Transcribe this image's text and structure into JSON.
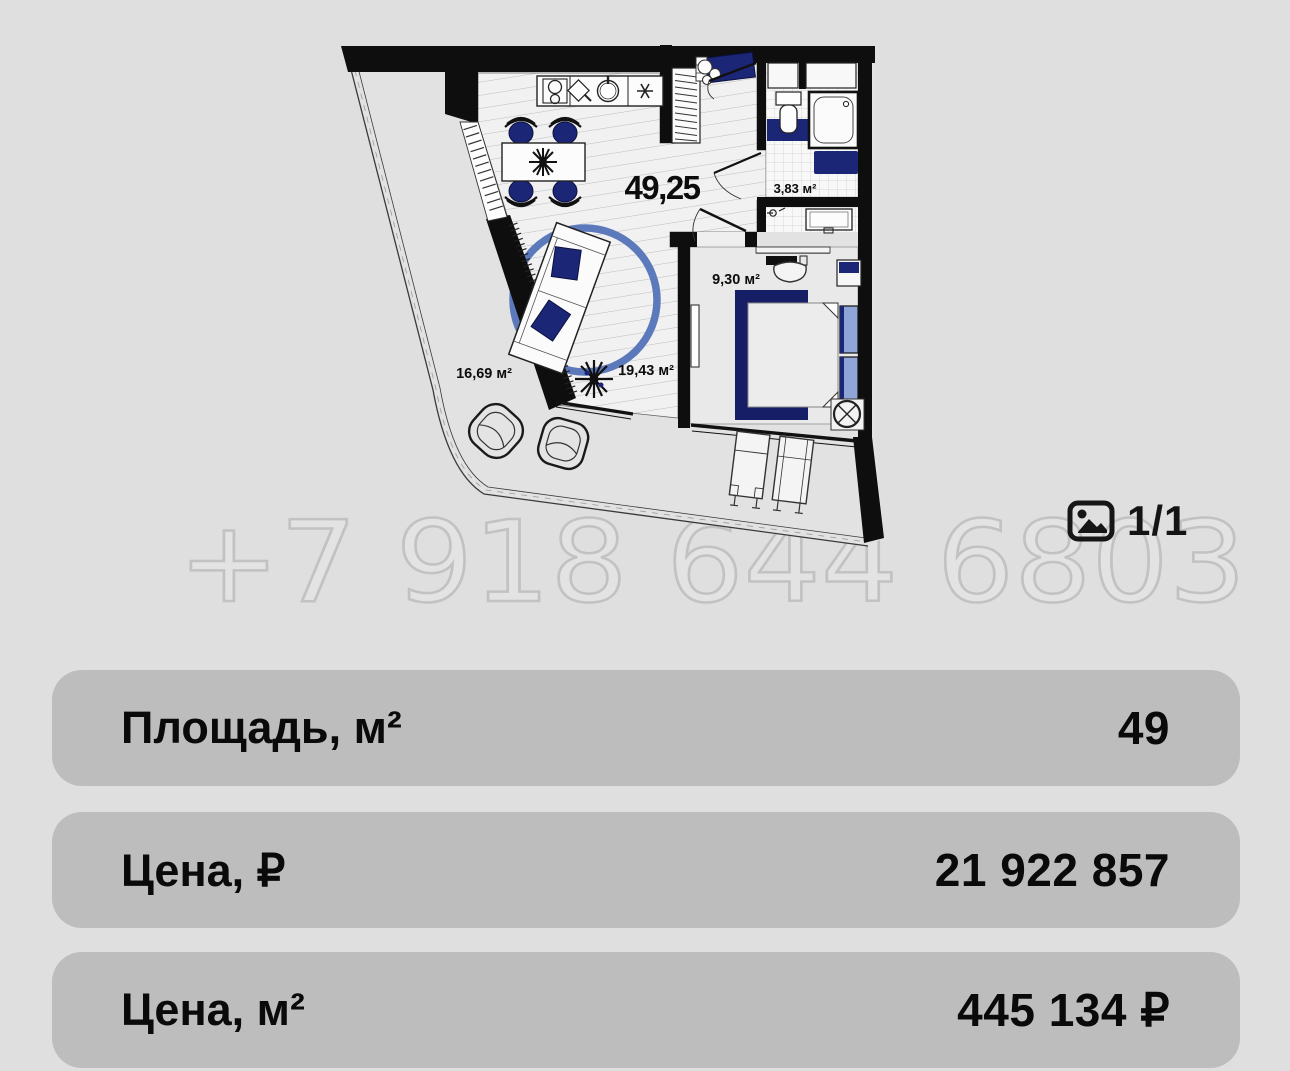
{
  "watermark": {
    "text": "+7 918 644 6803"
  },
  "gallery": {
    "counter": "1/1",
    "icon": "photo-icon"
  },
  "plan": {
    "total_area": "49,25",
    "rooms": [
      {
        "name": "bathroom",
        "area_label": "3,83 м²"
      },
      {
        "name": "bedroom",
        "area_label": "9,30 м²"
      },
      {
        "name": "balcony",
        "area_label": "16,69 м²"
      },
      {
        "name": "living-kitchen",
        "area_label": "19,43 м²"
      }
    ],
    "colors": {
      "wall": "#0e0e0e",
      "furniture_navy": "#1c2676",
      "pillow_blue": "#8ea5d6",
      "rug_blue": "#5b79bb",
      "row_background": "#bdbdbd",
      "page_background": "#dfdfdf"
    }
  },
  "details": {
    "rows": [
      {
        "label": "Площадь, м²",
        "value": "49"
      },
      {
        "label": "Цена, ₽",
        "value": "21 922 857"
      },
      {
        "label": "Цена, м²",
        "value": "445 134 ₽"
      }
    ]
  }
}
